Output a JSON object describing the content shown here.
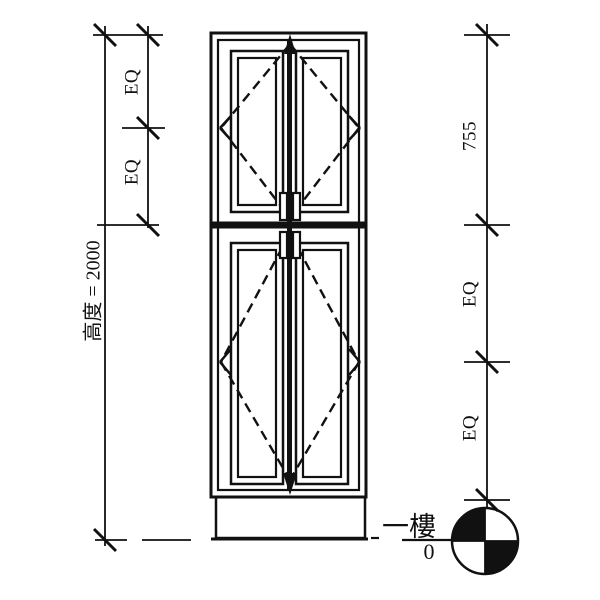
{
  "drawing": {
    "type": "cabinet-elevation",
    "background": "#ffffff",
    "line_color": "#111111"
  },
  "left_dimension": {
    "eq_upper": "EQ",
    "eq_lower": "EQ",
    "overall_height": "高度 = 2000"
  },
  "right_dimension": {
    "segment_top": "755",
    "segment_middle": "EQ",
    "segment_bottom": "EQ"
  },
  "level_marker": {
    "floor_name": "一樓",
    "elevation": "0"
  }
}
